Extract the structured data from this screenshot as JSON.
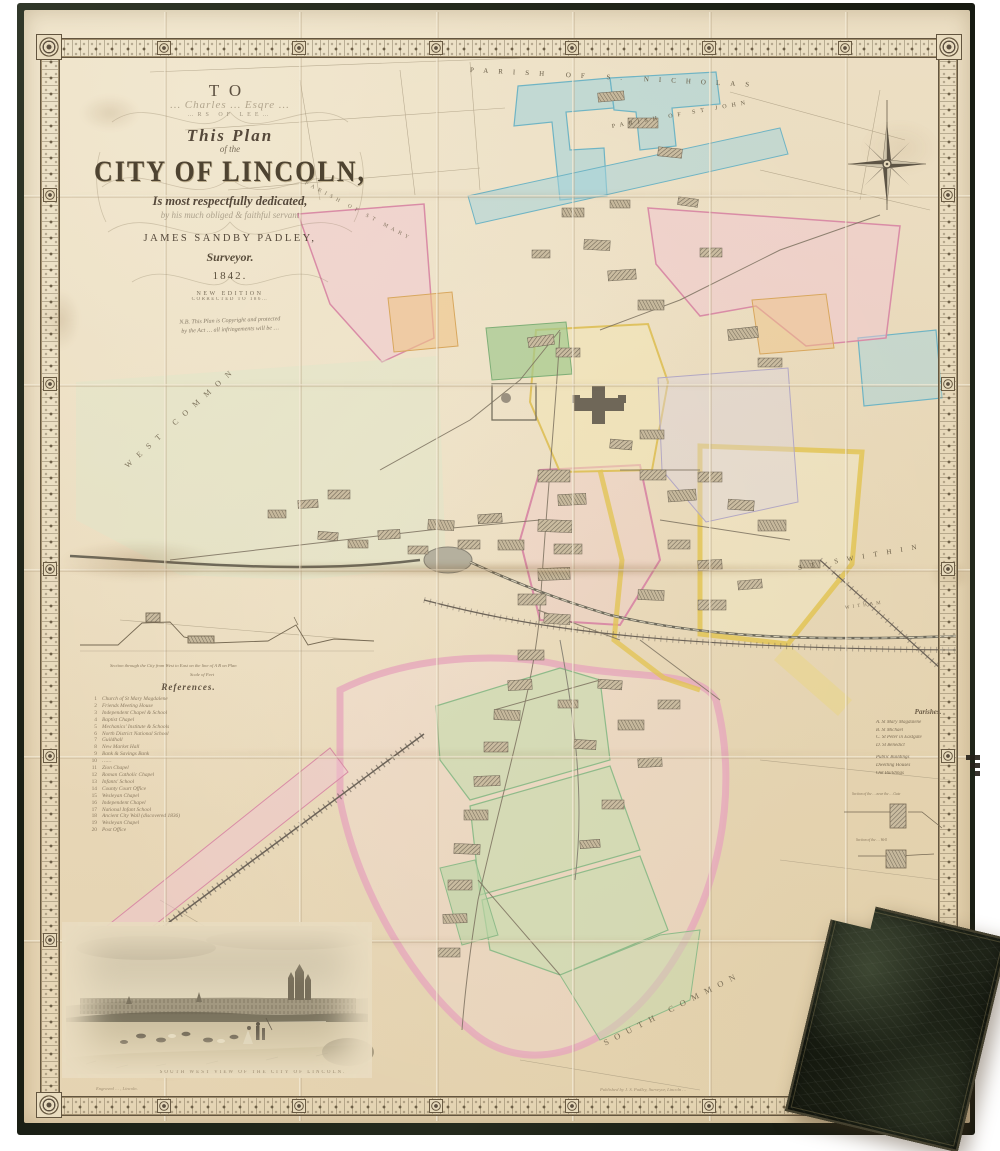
{
  "colors": {
    "background": "#ffffff",
    "paper": "#eadcc0",
    "ink": "#5f5340",
    "cloth": "#1d2217",
    "wash_blue": "#9fd0da",
    "wash_pink": "#efb9c9",
    "wash_yellow": "#e2c456",
    "wash_green": "#a8cc96",
    "wash_lilac": "#d9d3e2",
    "wash_orange": "#eec488",
    "case_leather": "#1d2115"
  },
  "title_block": {
    "to": "TO",
    "dedicatee_script": "… Charles … Esqre …",
    "dedicatee_caps": "…RS OF LEE…",
    "this_plan": "This Plan",
    "of_the": "of the",
    "city_title": "CITY OF LINCOLN,",
    "dedication": "Is most respectfully dedicated,",
    "servant_line": "by his much obliged & faithful servant",
    "author": "JAMES SANDBY PADLEY,",
    "role": "Surveyor.",
    "year": "1842.",
    "edition_line1": "NEW EDITION",
    "edition_line2": "CORRECTED TO 186…",
    "nb_line1": "N.B. This Plan is Copyright and protected",
    "nb_line2": "by the Act … all infringements will be …"
  },
  "labels": {
    "st_nicholas": "PARISH OF S. NICHOLAS",
    "st_john": "PARISH OF ST JOHN",
    "parish_curve": "PARISH OF ST MARY",
    "west_common": "WEST COMMON",
    "st_swithin": "ST SWITHIN",
    "witham": "WITHAM",
    "south_common": "SOUTH COMMON"
  },
  "references": {
    "title": "References.",
    "items": [
      "Church of St Mary Magdalene",
      "Friends Meeting House",
      "Independent Chapel & School",
      "Baptist Chapel",
      "Mechanics' Institute & Schools",
      "North District National School",
      "Guildhall",
      "New Market Hall",
      "Bank & Savings Bank",
      "……",
      "Zion Chapel",
      "Roman Catholic Chapel",
      "Infants' School",
      "County Court Office",
      "Wesleyan Chapel",
      "Independent Chapel",
      "National Infant School",
      "Ancient City Wall (discovered 1836)",
      "Wesleyan Chapel",
      "Post Office"
    ]
  },
  "parishes_legend": {
    "title": "Parishes.",
    "items": [
      "A.  St Mary Magdalene",
      "B.  St Michael",
      "C.  St Peter in Eastgate",
      "D.  St Benedict"
    ],
    "swatches": [
      "Public Buildings",
      "Dwelling Houses",
      "Out Buildings"
    ]
  },
  "sections": {
    "left_caption": "Section through the City from West to East on the line of A B on Plan",
    "left_scale": "Scale of Feet",
    "right_caption_1": "Section of the … near the … Gate",
    "right_caption_2": "Section of the … Well"
  },
  "vignette": {
    "caption": "SOUTH WEST VIEW OF THE CITY OF LINCOLN."
  },
  "imprints": {
    "bottom_left": "Engraved … , Lincoln.",
    "bottom_right": "Published by J. S. Padley, Surveyor, Lincoln …"
  }
}
